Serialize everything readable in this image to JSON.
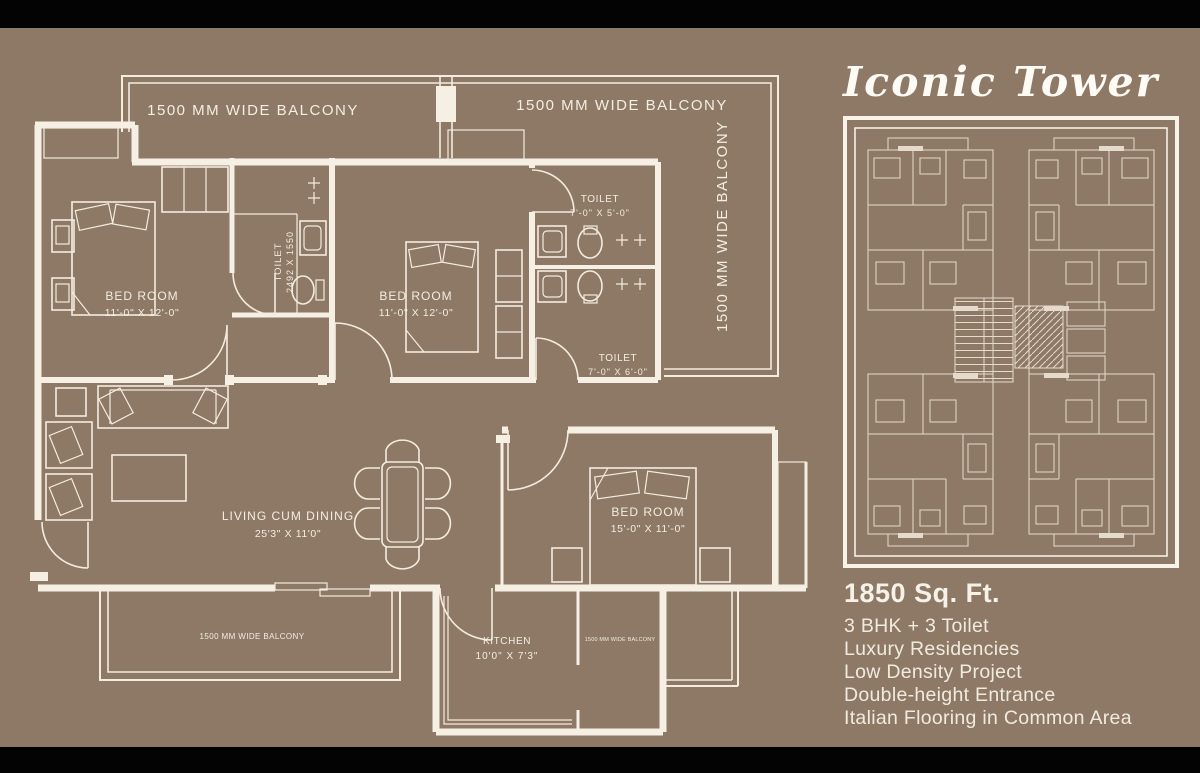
{
  "colors": {
    "background": "#8e7967",
    "line": "#f6f0e4",
    "text": "#f1ebdf",
    "letterbox": "#030303"
  },
  "floor_plan": {
    "balconies": {
      "top_left": "1500 MM WIDE BALCONY",
      "top_right": "1500 MM WIDE BALCONY",
      "right_vertical": "1500 MM WIDE BALCONY",
      "bottom": "1500 MM WIDE BALCONY",
      "rear": "1500 MM WIDE BALCONY"
    },
    "rooms": {
      "bedroom1": {
        "name": "BED ROOM",
        "dims": "11'-0\" X 12'-0\""
      },
      "toilet1": {
        "name": "TOILET",
        "dims": "2492 X 1550"
      },
      "bedroom2": {
        "name": "BED ROOM",
        "dims": "11'-0\" X 12'-0\""
      },
      "toilet2": {
        "name": "TOILET",
        "dims": "7'-0\" X 5'-0\""
      },
      "toilet3": {
        "name": "TOILET",
        "dims": "7'-0\" X 6'-0\""
      },
      "living": {
        "name": "LIVING CUM DINING",
        "dims": "25'3\" X 11'0\""
      },
      "bedroom3": {
        "name": "BED ROOM",
        "dims": "15'-0\" X 11'-0\""
      },
      "kitchen": {
        "name": "KITCHEN",
        "dims": "10'0\" X 7'3\""
      }
    }
  },
  "panel": {
    "title": "Iconic Tower",
    "area": "1850 Sq. Ft.",
    "specs": [
      "3 BHK + 3 Toilet",
      "Luxury Residencies",
      "Low Density Project",
      "Double-height Entrance",
      "Italian Flooring in Common Area"
    ]
  }
}
